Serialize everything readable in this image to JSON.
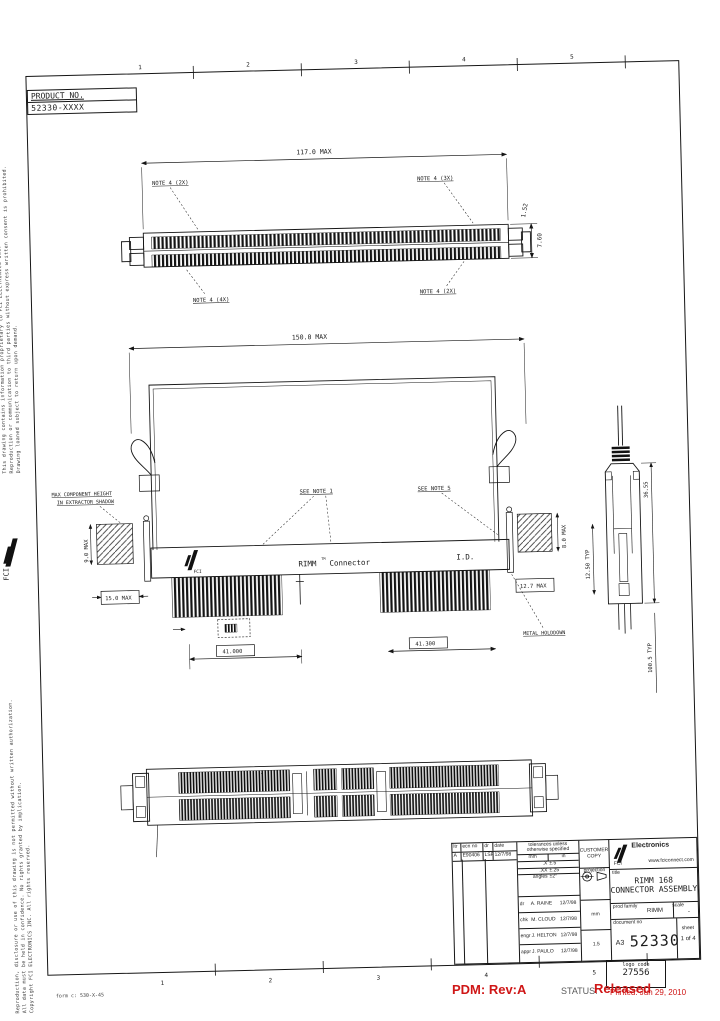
{
  "sheet": {
    "product_box": {
      "label": "PRODUCT NO.",
      "value": "52330-XXXX"
    },
    "zones_top": [
      "1",
      "2",
      "3",
      "4",
      "5"
    ],
    "zones_bottom": [
      "1",
      "2",
      "3",
      "4",
      "5"
    ],
    "form_note": "form c: 530-X-45",
    "margin_logo": "FCI",
    "proprietary_a1": "This drawing contains information proprietary to FCI ELECTRONICS INC.",
    "proprietary_a2": "Reproduction or communication to third parties without express written consent is prohibited.",
    "proprietary_a3": "Drawing loaned subject to return upon demand.",
    "proprietary_b1": "Reproduction, disclosure or use of this drawing is not permitted without written authorization.",
    "proprietary_b2": "All data must be held in confidence. No rights granted by implication.",
    "proprietary_b3": "Copyright FCI ELECTRONICS INC. All rights reserved."
  },
  "top_view": {
    "dim_length": "117.0 MAX",
    "dim_height": "7.60",
    "dim_lead": "1.52",
    "note_tl": "NOTE 4 (2X)",
    "note_tr": "NOTE 4 (3X)",
    "note_bl": "NOTE 4 (4X)",
    "note_br": "NOTE 4 (2X)"
  },
  "middle_view": {
    "dim_length": "150.0 MAX",
    "see_note_1": "SEE NOTE 1",
    "see_note_5": "SEE NOTE 5",
    "label_max_component_1": "MAX COMPONENT HEIGHT",
    "label_max_component_2": "IN EXTRACTOR SHADOW",
    "label_metal_holddown": "METAL HOLDDOWN",
    "brand": "RIMM",
    "brand_tm": "TM",
    "brand_suffix": "Connector",
    "id_label": "I.D.",
    "fci_logo": "FCI",
    "dim_left_v": "9.0 MAX",
    "dim_left_box": "15.0 MAX",
    "dim_right_v": "8.0 MAX",
    "dim_right_box": "12.7 MAX",
    "dim_41a": "41.000",
    "dim_41b": "41.300"
  },
  "side_view": {
    "dim_a": "36.55",
    "dim_b": "12.50 TYP",
    "dim_c": "100.5 TYP"
  },
  "title_block": {
    "revision": {
      "h0": "ltr",
      "h1": "ecn no",
      "h2": "dr",
      "h3": "date",
      "r0": "A",
      "r1": "E90406",
      "r2": "LSF",
      "r3": "12/7/98"
    },
    "tol_title1": "tolerances unless",
    "tol_title2": "otherwise specified",
    "unit_mm": "mm",
    "unit_in": "in",
    "tol_x_l": ".X",
    "tol_x_v": "±.5",
    "tol_xx_l": ".XX",
    "tol_xx_v": "±.25",
    "tol_ang_l": "angles",
    "tol_ang_v": "±2°",
    "appr0_role": "dr",
    "appr0_name": "A. RAINE",
    "appr0_date": "12/7/98",
    "appr1_role": "chk",
    "appr1_name": "M. CLOUD",
    "appr1_date": "12/7/98",
    "appr2_role": "engr",
    "appr2_name": "J. HELTON",
    "appr2_date": "12/7/98",
    "appr3_role": "appr",
    "appr3_name": "J. PAULO",
    "appr3_date": "12/7/98",
    "units": "mm",
    "scale_small": "1.5",
    "customer_copy_1": "CUSTOMER",
    "customer_copy_2": "COPY",
    "projection_label": "projection",
    "company": "Electronics",
    "company_logo": "FCI",
    "website": "www.fciconnect.com",
    "title_label": "title",
    "title_line1": "RIMM 168",
    "title_line2": "CONNECTOR ASSEMBLY",
    "prod_family_label": "prod family",
    "prod_family": "RIMM",
    "scale_label": "scale",
    "scale": "-",
    "doc_label": "document no",
    "size": "A3",
    "doc_no": "52330",
    "sheet_label": "sheet",
    "sheet": "1 of 4"
  },
  "pdm_footer": {
    "pdm": "PDM: Rev:A",
    "status_label": "STATUS:",
    "status_value": "Released",
    "logo_code_label": "logo code",
    "logo_code": "27556",
    "printed": "Printed: Jun 29, 2010"
  }
}
